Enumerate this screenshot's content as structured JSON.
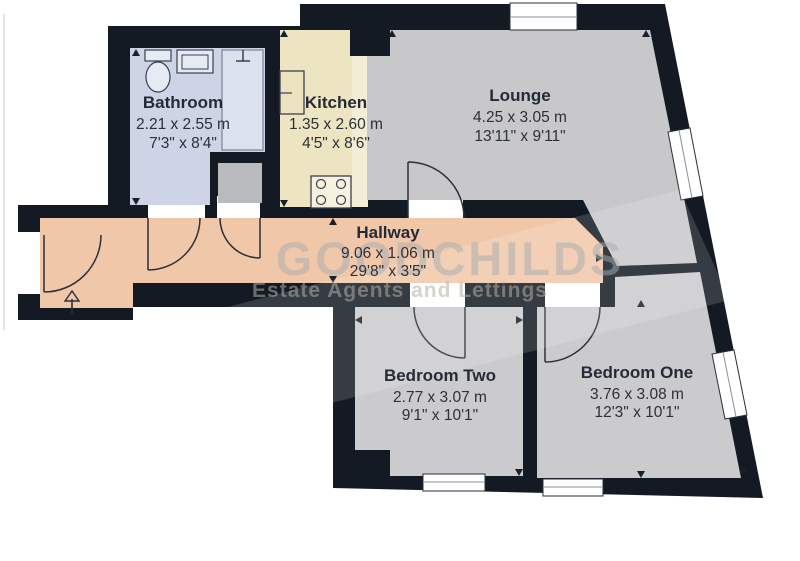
{
  "plan_title": "Flat floor plan",
  "watermark": {
    "name": "GOODCHILDS",
    "tagline": "Estate Agents and Lettings"
  },
  "colors": {
    "wall": "#131a24",
    "bathroom": "#ccd4e6",
    "shower": "#dde2ef",
    "kitchen": "#ede4c1",
    "counter": "#f4edd6",
    "hallway": "#f0c7a8",
    "lounge": "#c8c8ca",
    "bedroom": "#cbcbcd",
    "cupboard": "#b9babc",
    "text": "#252b36"
  },
  "rooms": {
    "bathroom": {
      "name": "Bathroom",
      "metric": "2.21 x 2.55 m",
      "imperial": "7'3\" x 8'4\""
    },
    "kitchen": {
      "name": "Kitchen",
      "metric": "1.35 x 2.60 m",
      "imperial": "4'5\" x 8'6\""
    },
    "lounge": {
      "name": "Lounge",
      "metric": "4.25 x 3.05 m",
      "imperial": "13'11\" x 9'11\""
    },
    "hallway": {
      "name": "Hallway",
      "metric": "9.06 x 1.06 m",
      "imperial": "29'8\" x 3'5\""
    },
    "bedroom_two": {
      "name": "Bedroom Two",
      "metric": "2.77 x 3.07 m",
      "imperial": "9'1\" x 10'1\""
    },
    "bedroom_one": {
      "name": "Bedroom One",
      "metric": "3.76 x 3.08 m",
      "imperial": "12'3\" x 10'1\""
    }
  }
}
